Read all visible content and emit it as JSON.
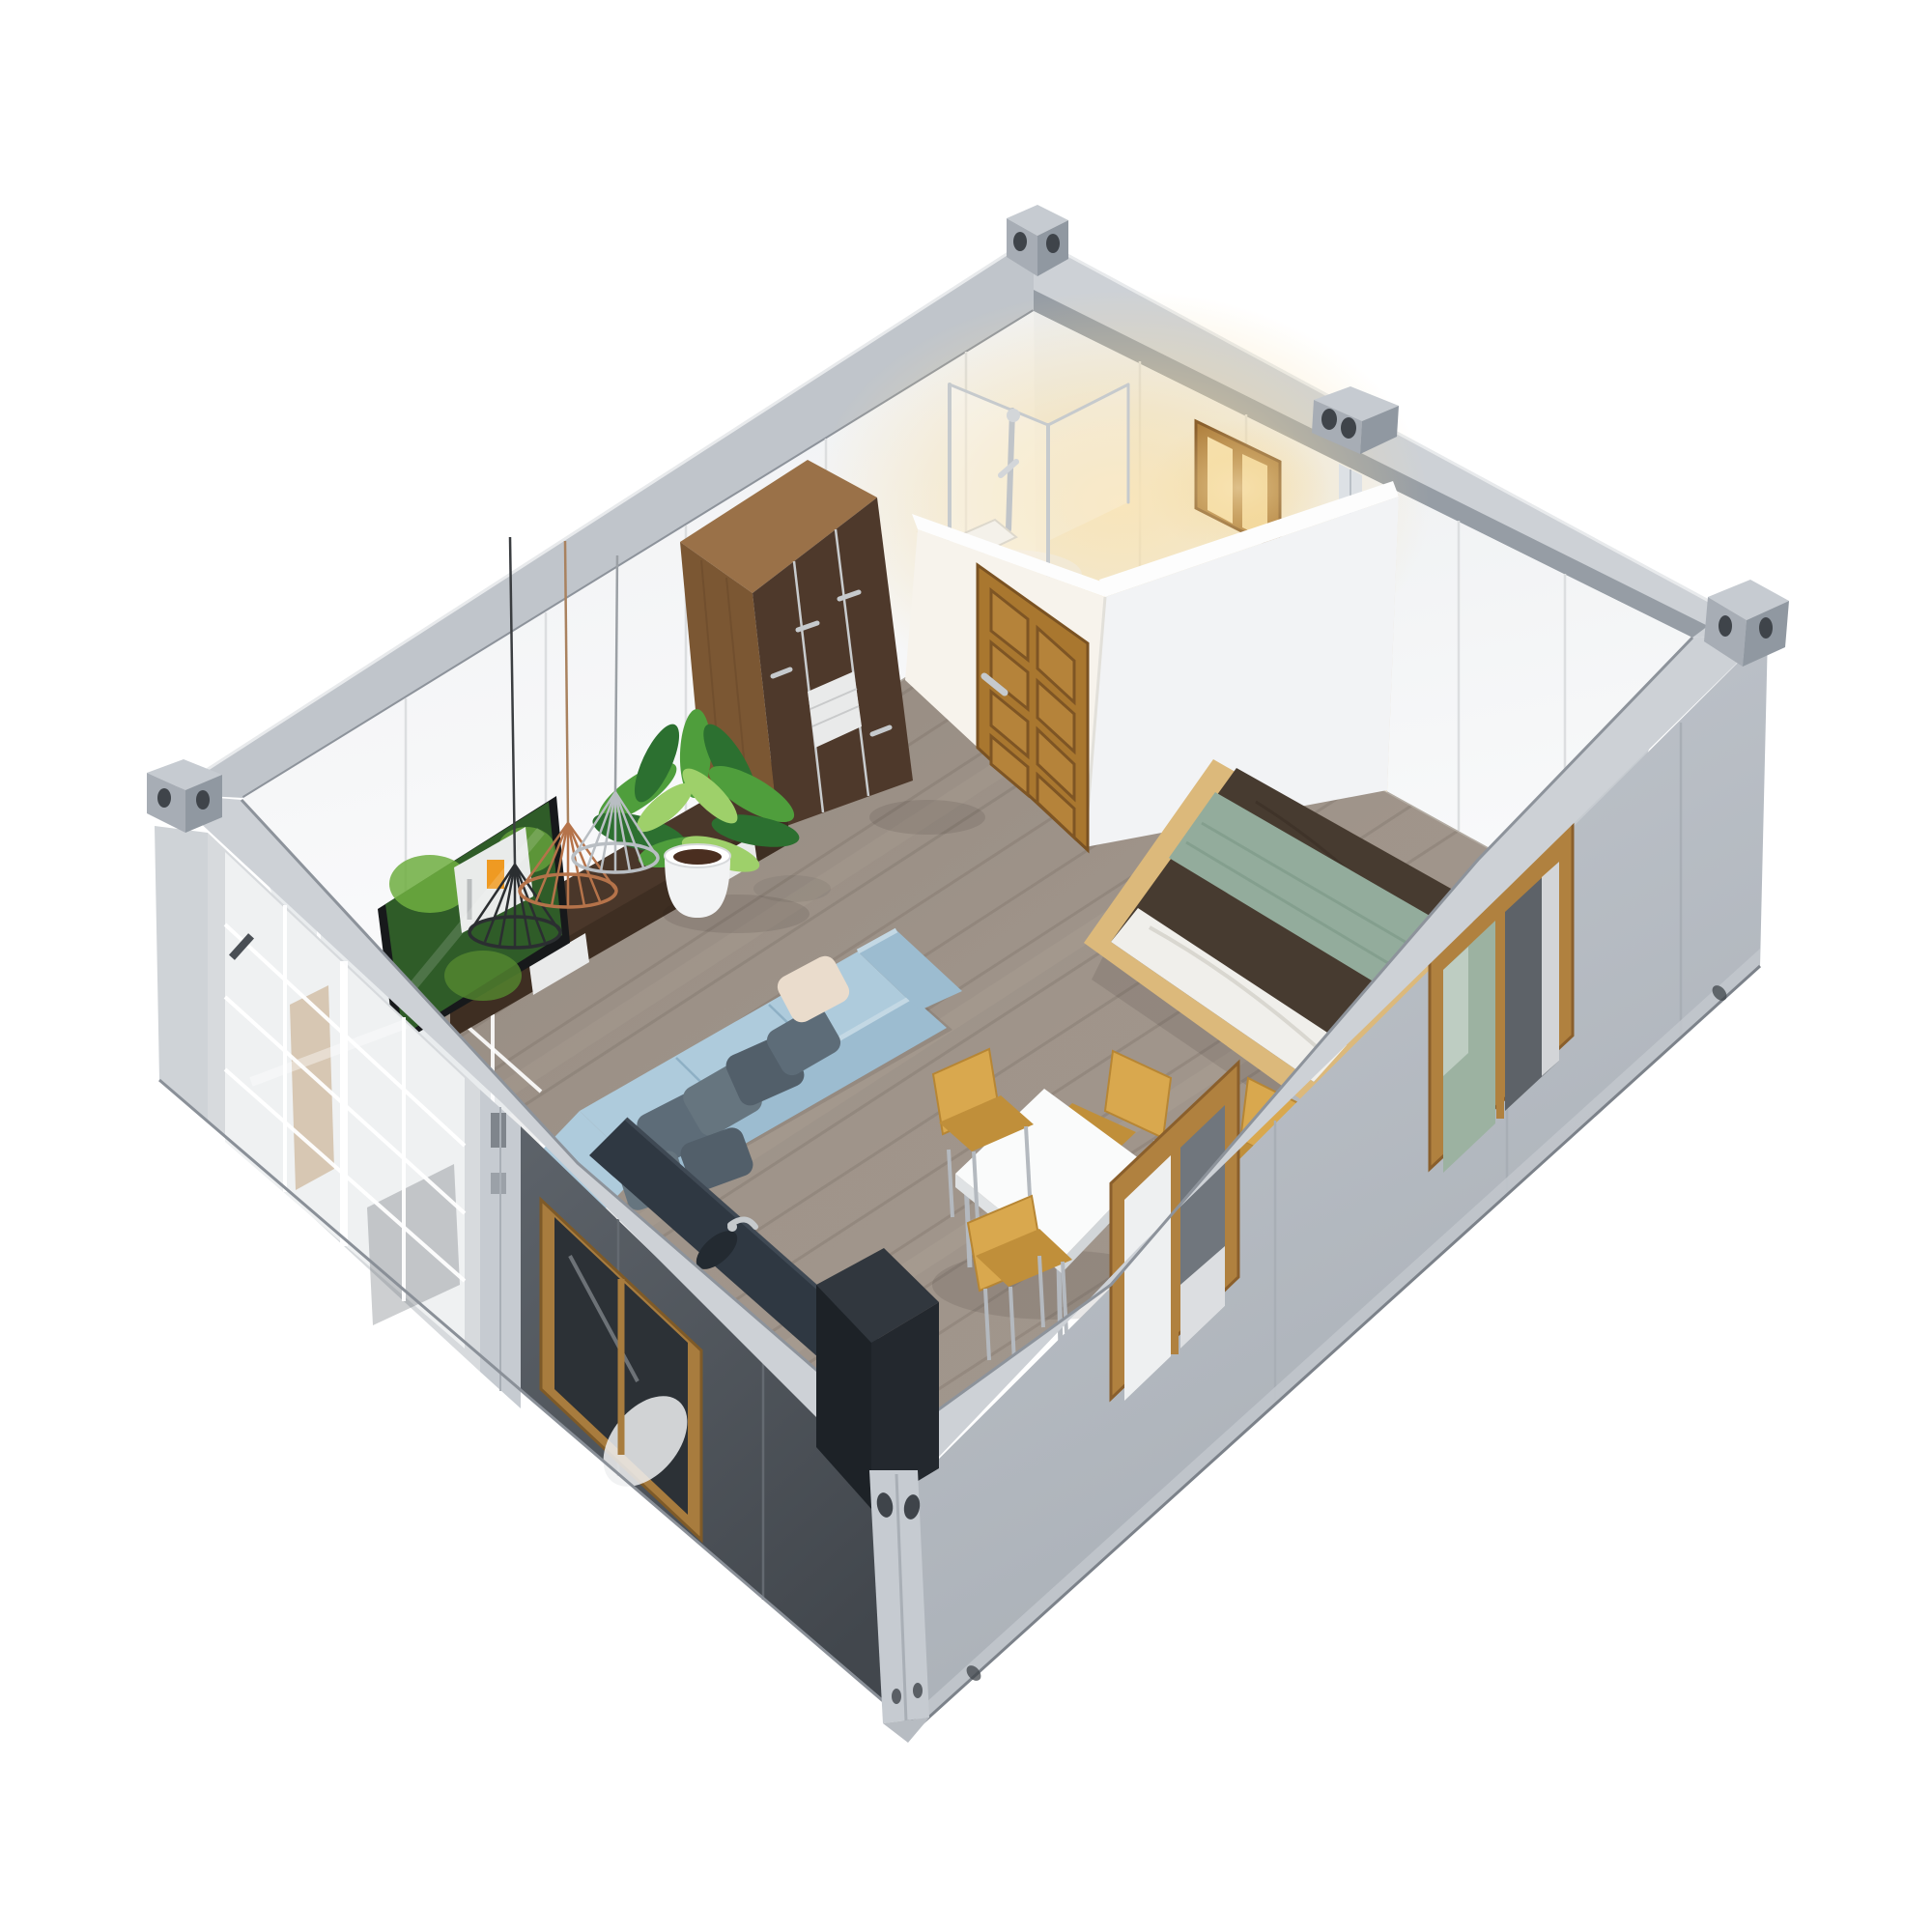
{
  "scene": {
    "title": "3D isometric cutaway render of a flat-pack container house interior on a white background",
    "type": "architectural-render",
    "rooms": [
      "living-area",
      "bedroom-area",
      "bathroom",
      "kitchenette",
      "dining-area"
    ],
    "objects": [
      "container shell with corner castings",
      "sliding glass door",
      "exterior windows with wood frames",
      "bathroom with glass shower and lit window",
      "wooden eight-panel door",
      "dark walnut wardrobe",
      "flat screen TV on walnut media cabinet",
      "three wire pendant lamps",
      "potted plant",
      "light blue L-shaped sofa with gray pillows",
      "dark kitchen counter with sink and appliance",
      "white square dining table with four wooden chairs",
      "platform bed with brown duvet and sage throw"
    ]
  },
  "colors": {
    "bg": "#ffffff",
    "rim_light": "#cdd1d6",
    "rim_mid": "#c0c5cb",
    "rim_dark_lip": "#8d939b",
    "rim_inner_dark": "#969da5",
    "casting_light": "#c6cbd1",
    "casting_mid": "#a7adb5",
    "casting_dark": "#9098a1",
    "casting_hole": "#3f444a",
    "wall_white": "#f4f5f6",
    "wall_white_bright": "#fbfbfc",
    "wall_seam": "#dcdee0",
    "partition_white": "#f2f3f5",
    "partition_warm": "#f7f3ec",
    "partition_top": "#fdfdfd",
    "se_inner": "#c6cbd0",
    "ext_light_gray": "#b6bbc2",
    "ext_light_gray_dark": "#a8aeb5",
    "ext_dark": "#565c63",
    "ext_dark_deep": "#43484e",
    "door_unit_frame": "#d7dadd",
    "glass_light": "#eff1f2",
    "grid_white": "#ffffff",
    "post_gray": "#c6cbd1",
    "floor_base": "#a2978d",
    "floor_dark_line": "#857b72",
    "floor_light_line": "#b6aca1",
    "floor_tv_dark": "#4a392c",
    "floor_tv_line": "#61492f",
    "skirting": "#eceff0",
    "bath_floor": "#e9dfcd",
    "glow_warm": "#f8e0a8",
    "wood_walnut_top": "#9a7148",
    "wood_walnut_side": "#7b5733",
    "wood_grain": "#6a4a2c",
    "wardrobe_door": "#4e392b",
    "wardrobe_seam": "#c9ccce",
    "drawer_white": "#e9eaea",
    "door_wood": "#a9772f",
    "door_wood_dark": "#7e5524",
    "door_wood_panel": "#b5833a",
    "handle_silver": "#c6cacd",
    "tv_frame": "#17191b",
    "tv_green_dark": "#2f5c28",
    "tv_green_light": "#6fae3f",
    "tv_house_white": "#e9ebea",
    "tv_window_orange": "#ef9a22",
    "cabinet_dark": "#4a372a",
    "cabinet_front": "#3e2e22",
    "pot_white": "#f2f3f4",
    "soil_dark": "#4a2e20",
    "leaf_dark": "#2c7030",
    "leaf_mid": "#4f9e3c",
    "leaf_light": "#9ed06a",
    "lamp_black": "#2b2e31",
    "lamp_copper": "#b5734a",
    "lamp_silver": "#b9bec3",
    "cord_dark": "#3a3d40",
    "bed_platform": "#dcb97b",
    "duvet_brown": "#473b30",
    "duvet_fold": "#382e25",
    "throw_green": "#93ac9c",
    "throw_green_dark": "#7e9a89",
    "sheet_white": "#f0efeb",
    "sheet_fold": "#d9d7d0",
    "sofa_seat": "#aecbdc",
    "sofa_back": "#9cbcd0",
    "sofa_shadow": "#86a9bf",
    "sofa_highlight": "#c3d8e4",
    "pillow_dark": "#5d6c78",
    "pillow_mid": "#66757f",
    "pillow_deep": "#525f6a",
    "pillow_cream": "#eadccc",
    "counter_dark": "#2f3842",
    "counter_deep": "#232a31",
    "counter_sheen": "#3f4954",
    "appliance_top": "#31373e",
    "appliance_front": "#23282e",
    "appliance_side": "#1d2227",
    "table_white": "#fafbfb",
    "table_edge": "#dfe2e4",
    "table_edge_dark": "#d2d6d9",
    "chair_wood": "#d9a84e",
    "chair_wood_dark": "#c08f3a",
    "leg_metal": "#b4b9bf",
    "window_frame_wood": "#b0813f",
    "window_frame_dark": "#a87c3e",
    "window_dark": "#70767d",
    "window_deep": "#5d6268",
    "curtain_white": "#eef0f1",
    "sage_glimpse": "#9cb2a1",
    "corner_trim": "#cfd3d7",
    "flange_light": "#c2c7cd"
  }
}
